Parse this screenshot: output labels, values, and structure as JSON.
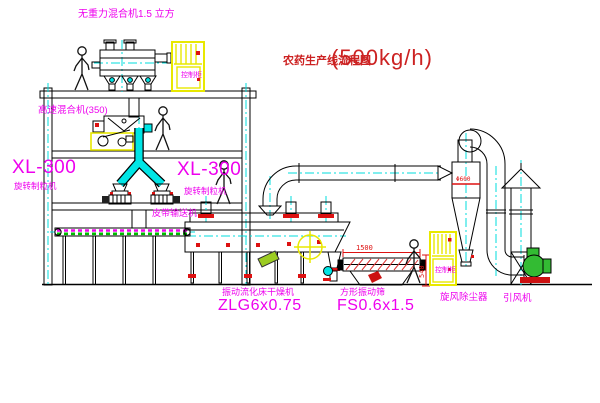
{
  "drawing_title": {
    "name": "农药生产线流程图",
    "capacity": "(500kg/h)"
  },
  "labels": {
    "no_gravity_mixer": "无重力混合机1.5 立方",
    "high_speed_mixer": "高速混合机(350)",
    "granulator_left": {
      "model": "XL-300",
      "name": "旋转制粒机"
    },
    "granulator_right": {
      "model": "XL-300",
      "name": "旋转制粒机"
    },
    "belt_conveyor": "皮带输送机",
    "dryer": {
      "name": "振动流化床干燥机",
      "model": "ZLG6x0.75"
    },
    "screen": {
      "name": "方形振动筛",
      "model": "FS0.6x1.5"
    },
    "cyclone": "旋风除尘器",
    "fan": "引风机",
    "control_cabinet_upper": "控制柜",
    "control_cabinet_lower": "控制柜"
  },
  "dimensions": {
    "screen_length": "1500",
    "screen_height": "540",
    "cyclone_diameter": "Φ600"
  },
  "colors": {
    "label_magenta": "#ee00ee",
    "title_red": "#cc2222",
    "dimension_red": "#dd1111",
    "centerline_cyan": "#00dddd",
    "highlight_yellow": "#f0f000",
    "machine_green": "#33bb33",
    "conveyor_green": "#00bb00",
    "flange_red": "#dd1111",
    "line_black": "#000000"
  }
}
